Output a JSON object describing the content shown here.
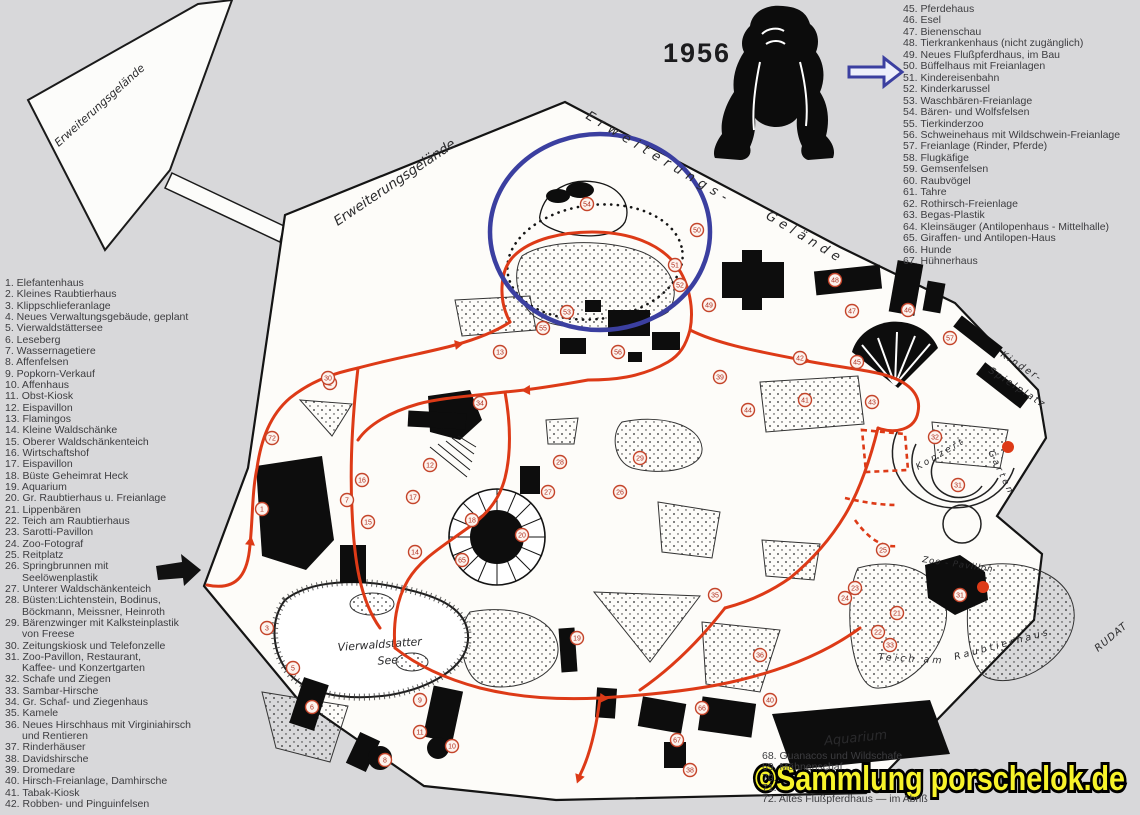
{
  "year_label": "1956",
  "watermark": {
    "text": "©Sammlung porschelok.de",
    "fill": "#f7f32a",
    "outline": "#000000"
  },
  "colors": {
    "route_red": "#dd3a17",
    "annotation_blue": "#3b3fa0",
    "paper": "#fdfcf9",
    "background": "#d8d8da"
  },
  "map_labels": {
    "expansion_parcel": "Erweiterungsgelände",
    "expansion_inner": "Erweiterungsgelände",
    "expansion_boundary_1": "Erweiterungs-",
    "expansion_boundary_2": "Gelände",
    "playground_line1": "Kinder-",
    "playground_line2": "Spielplatz",
    "concert_garden_1": "Konzert",
    "concert_garden_2": "Garten",
    "zoo_pavilion": "Zoo - Pavillon",
    "pond_at": "Teich am",
    "predator_house": "Raubtierhaus",
    "lake_line1": "Vierwaldstatter",
    "lake_line2": "See",
    "aquarium": "Aquarium",
    "signature": "RUDAT"
  },
  "legend_left": {
    "items": [
      {
        "num": "1.",
        "label": "Elefantenhaus"
      },
      {
        "num": "2.",
        "label": "Kleines Raubtierhaus"
      },
      {
        "num": "3.",
        "label": "Klippschlieferanlage"
      },
      {
        "num": "4.",
        "label": "Neues Verwaltungsgebäude, geplant"
      },
      {
        "num": "5.",
        "label": "Vierwaldstättersee"
      },
      {
        "num": "6.",
        "label": "Leseberg"
      },
      {
        "num": "7.",
        "label": "Wassernagetiere"
      },
      {
        "num": "8.",
        "label": "Affenfelsen"
      },
      {
        "num": "9.",
        "label": "Popkorn-Verkauf"
      },
      {
        "num": "10.",
        "label": "Affenhaus"
      },
      {
        "num": "11.",
        "label": "Obst-Kiosk"
      },
      {
        "num": "12.",
        "label": "Eispavillon"
      },
      {
        "num": "13.",
        "label": "Flamingos"
      },
      {
        "num": "14.",
        "label": "Kleine Waldschänke"
      },
      {
        "num": "15.",
        "label": "Oberer Waldschänkenteich"
      },
      {
        "num": "16.",
        "label": "Wirtschaftshof"
      },
      {
        "num": "17.",
        "label": "Eispavillon"
      },
      {
        "num": "18.",
        "label": "Büste Geheimrat Heck"
      },
      {
        "num": "19.",
        "label": "Aquarium"
      },
      {
        "num": "20.",
        "label": "Gr. Raubtierhaus u. Freianlage"
      },
      {
        "num": "21.",
        "label": "Lippenbären"
      },
      {
        "num": "22.",
        "label": "Teich am Raubtierhaus"
      },
      {
        "num": "23.",
        "label": "Sarotti-Pavillon"
      },
      {
        "num": "24.",
        "label": "Zoo-Fotograf"
      },
      {
        "num": "25.",
        "label": "Reitplatz"
      },
      {
        "num": "26.",
        "label": "Springbrunnen mit\nSeelöwenplastik"
      },
      {
        "num": "27.",
        "label": "Unterer Waldschänkenteich"
      },
      {
        "num": "28.",
        "label": "Büsten:Lichtenstein, Bodinus,\nBöckmann, Meissner, Heinroth"
      },
      {
        "num": "29.",
        "label": "Bärenzwinger mit Kalksteinplastik\nvon Freese"
      },
      {
        "num": "30.",
        "label": "Zeitungskiosk und Telefonzelle"
      },
      {
        "num": "31.",
        "label": "Zoo-Pavillon, Restaurant,\nKaffee- und Konzertgarten"
      },
      {
        "num": "32.",
        "label": "Schafe und Ziegen"
      },
      {
        "num": "33.",
        "label": "Sambar-Hirsche"
      },
      {
        "num": "34.",
        "label": "Gr. Schaf- und Ziegenhaus"
      },
      {
        "num": "35.",
        "label": "Kamele"
      },
      {
        "num": "36.",
        "label": "Neues Hirschhaus mit Virginiahirsch\nund Rentieren"
      },
      {
        "num": "37.",
        "label": "Rinderhäuser"
      },
      {
        "num": "38.",
        "label": "Davidshirsche"
      },
      {
        "num": "39.",
        "label": "Dromedare"
      },
      {
        "num": "40.",
        "label": "Hirsch-Freianlage, Damhirsche"
      },
      {
        "num": "41.",
        "label": "Tabak-Kiosk"
      },
      {
        "num": "42.",
        "label": "Robben- und Pinguinfelsen"
      }
    ]
  },
  "legend_right": {
    "items": [
      {
        "num": "45.",
        "label": "Pferdehaus"
      },
      {
        "num": "46.",
        "label": "Esel"
      },
      {
        "num": "47.",
        "label": "Bienenschau"
      },
      {
        "num": "48.",
        "label": "Tierkrankenhaus (nicht zugänglich)"
      },
      {
        "num": "49.",
        "label": "Neues Flußpferdhaus, im Bau"
      },
      {
        "num": "50.",
        "label": "Büffelhaus mit Freianlagen"
      },
      {
        "num": "51.",
        "label": "Kindereisenbahn"
      },
      {
        "num": "52.",
        "label": "Kinderkarussel"
      },
      {
        "num": "53.",
        "label": "Waschbären-Freianlage"
      },
      {
        "num": "54.",
        "label": "Bären- und Wolfsfelsen"
      },
      {
        "num": "55.",
        "label": "Tierkinderzoo"
      },
      {
        "num": "56.",
        "label": "Schweinehaus mit Wildschwein-Freianlage"
      },
      {
        "num": "57.",
        "label": "Freianlage (Rinder, Pferde)"
      },
      {
        "num": "58.",
        "label": "Flugkäfige"
      },
      {
        "num": "59.",
        "label": "Gemsenfelsen"
      },
      {
        "num": "60.",
        "label": "Raubvögel"
      },
      {
        "num": "61.",
        "label": "Tahre"
      },
      {
        "num": "62.",
        "label": "Rothirsch-Freienlage"
      },
      {
        "num": "63.",
        "label": "Begas-Plastik"
      },
      {
        "num": "64.",
        "label": "Kleinsäuger (Antilopenhaus - Mittelhalle)"
      },
      {
        "num": "65.",
        "label": "Giraffen- und Antilopen-Haus"
      },
      {
        "num": "66.",
        "label": "Hunde"
      },
      {
        "num": "67.",
        "label": "Hühnerhaus"
      }
    ]
  },
  "legend_bottom": {
    "items": [
      {
        "num": "68.",
        "label": "Guanacos und Wildschafe"
      },
      {
        "num": "69.",
        "label": "Mähnenschaf"
      },
      {
        "num": "70.",
        "label": ""
      },
      {
        "num": "71.",
        "label": ""
      },
      {
        "num": "72.",
        "label": "Altes Flußpferdhaus — im Abriß"
      }
    ]
  },
  "markers": [
    {
      "n": "1",
      "x": 262,
      "y": 509
    },
    {
      "n": "2",
      "x": 330,
      "y": 383
    },
    {
      "n": "3",
      "x": 267,
      "y": 628
    },
    {
      "n": "5",
      "x": 293,
      "y": 668
    },
    {
      "n": "6",
      "x": 312,
      "y": 707
    },
    {
      "n": "7",
      "x": 347,
      "y": 500
    },
    {
      "n": "8",
      "x": 385,
      "y": 760
    },
    {
      "n": "9",
      "x": 420,
      "y": 700
    },
    {
      "n": "10",
      "x": 452,
      "y": 746
    },
    {
      "n": "11",
      "x": 420,
      "y": 732
    },
    {
      "n": "12",
      "x": 430,
      "y": 465
    },
    {
      "n": "13",
      "x": 500,
      "y": 352
    },
    {
      "n": "14",
      "x": 415,
      "y": 552
    },
    {
      "n": "15",
      "x": 368,
      "y": 522
    },
    {
      "n": "16",
      "x": 362,
      "y": 480
    },
    {
      "n": "17",
      "x": 413,
      "y": 497
    },
    {
      "n": "18",
      "x": 472,
      "y": 520
    },
    {
      "n": "19",
      "x": 577,
      "y": 638
    },
    {
      "n": "20",
      "x": 522,
      "y": 535
    },
    {
      "n": "21",
      "x": 897,
      "y": 613
    },
    {
      "n": "22",
      "x": 878,
      "y": 632
    },
    {
      "n": "23",
      "x": 855,
      "y": 588
    },
    {
      "n": "24",
      "x": 845,
      "y": 598
    },
    {
      "n": "25",
      "x": 883,
      "y": 550
    },
    {
      "n": "26",
      "x": 620,
      "y": 492
    },
    {
      "n": "27",
      "x": 548,
      "y": 492
    },
    {
      "n": "28",
      "x": 560,
      "y": 462
    },
    {
      "n": "29",
      "x": 640,
      "y": 458
    },
    {
      "n": "30",
      "x": 328,
      "y": 378
    },
    {
      "n": "31",
      "x": 958,
      "y": 485
    },
    {
      "n": "31",
      "x": 960,
      "y": 595
    },
    {
      "n": "32",
      "x": 935,
      "y": 437
    },
    {
      "n": "33",
      "x": 890,
      "y": 645
    },
    {
      "n": "34",
      "x": 480,
      "y": 403
    },
    {
      "n": "35",
      "x": 715,
      "y": 595
    },
    {
      "n": "36",
      "x": 760,
      "y": 655
    },
    {
      "n": "38",
      "x": 690,
      "y": 770
    },
    {
      "n": "39",
      "x": 720,
      "y": 377
    },
    {
      "n": "40",
      "x": 770,
      "y": 700
    },
    {
      "n": "41",
      "x": 805,
      "y": 400
    },
    {
      "n": "42",
      "x": 800,
      "y": 358
    },
    {
      "n": "43",
      "x": 872,
      "y": 402
    },
    {
      "n": "44",
      "x": 748,
      "y": 410
    },
    {
      "n": "45",
      "x": 857,
      "y": 362
    },
    {
      "n": "46",
      "x": 908,
      "y": 310
    },
    {
      "n": "47",
      "x": 852,
      "y": 311
    },
    {
      "n": "48",
      "x": 835,
      "y": 280
    },
    {
      "n": "49",
      "x": 709,
      "y": 305
    },
    {
      "n": "50",
      "x": 697,
      "y": 230
    },
    {
      "n": "51",
      "x": 675,
      "y": 265
    },
    {
      "n": "52",
      "x": 680,
      "y": 285
    },
    {
      "n": "53",
      "x": 567,
      "y": 312
    },
    {
      "n": "54",
      "x": 587,
      "y": 204
    },
    {
      "n": "55",
      "x": 543,
      "y": 328
    },
    {
      "n": "56",
      "x": 618,
      "y": 352
    },
    {
      "n": "57",
      "x": 950,
      "y": 338
    },
    {
      "n": "65",
      "x": 462,
      "y": 560
    },
    {
      "n": "66",
      "x": 702,
      "y": 708
    },
    {
      "n": "67",
      "x": 677,
      "y": 740
    },
    {
      "n": "72",
      "x": 272,
      "y": 438
    }
  ]
}
